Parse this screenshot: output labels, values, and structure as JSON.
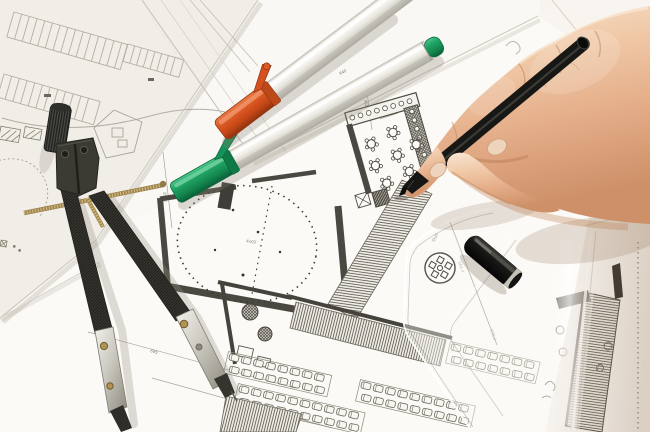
{
  "scene": {
    "type": "photograph",
    "description": "Top-down photo of an architect's desk: a right hand holding a black fineliner annotates overlapping floor-plan blueprints; a drafting compass with spread legs, two silver markers with orange and green caps, a black pen cap and a transparent set square rest on the drawings.",
    "objects": {
      "compass": "drafting compass",
      "orange_marker": "silver marker with orange cap",
      "green_marker": "silver marker with green cap",
      "black_pen": "black fineliner pen",
      "pen_cap": "black pen cap",
      "set_square": "transparent set square ruler",
      "hand": "right hand writing",
      "blueprints": "overlapping architectural plan sheets"
    },
    "colors": {
      "paper": "#f7f4ef",
      "plan_line_faint": "#b3afa4",
      "plan_line": "#6b675c",
      "plan_wall": "#4a4840",
      "orange_cap": "#d4511f",
      "green_cap": "#17915a",
      "marker_body": "#e9e7e0",
      "pen_black": "#171715",
      "cap_ring": "#c6c4b8",
      "compass_dark": "#35342e",
      "metal": "#c9c6bd",
      "brass": "#a58b4d",
      "skin": "#eec09d",
      "skin_shadow": "#c98d68",
      "nail": "#eed3bd",
      "ruler_tint": "rgba(253,251,245,0.42)",
      "shadow_warm": "rgba(146,112,82,0.28)"
    },
    "annotations": {
      "microtext_row": "··· ···· ·· ····· ···· ······ ·····",
      "dim_685": "685",
      "dim_630": "630",
      "dim_3502": "3502",
      "dim_4605": "4605",
      "dim_1600": "1600",
      "dim_840": "840",
      "dim_5752": "575.2",
      "dim_2614": "261.4",
      "dim_480": "480",
      "dim_402": "4x02",
      "dim_150": "150",
      "band_label": "120.50",
      "ruler_brand": "Quill"
    }
  }
}
